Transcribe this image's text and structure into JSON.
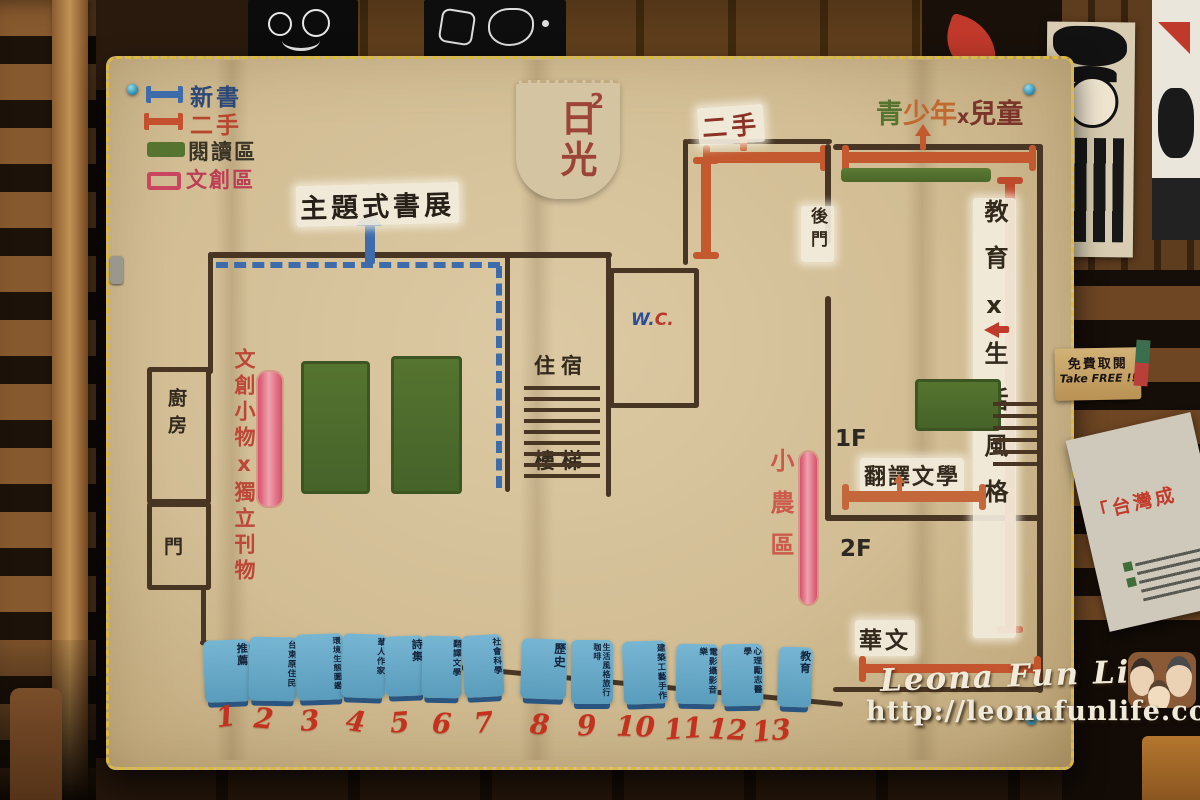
{
  "legend": {
    "items": [
      {
        "label": "新書",
        "color": "#3e6cab",
        "swatch": "ibeam"
      },
      {
        "label": "二手",
        "color": "#c4592f",
        "swatch": "ibeam"
      },
      {
        "label": "閱讀區",
        "color": "#55742f",
        "swatch": "filled"
      },
      {
        "label": "文創區",
        "color": "#c94560",
        "swatch": "outline"
      }
    ]
  },
  "store_tag": {
    "name": "日光",
    "sup": "2"
  },
  "map": {
    "title": "主題式書展",
    "labels": {
      "secondhand_top": "二手",
      "teen_green": "青",
      "teen_orange": "少年",
      "teen_x": "x",
      "teen_red": "兒童",
      "education": "教育x生活風格",
      "back_door": "後門",
      "stairs_line1": "住宿",
      "stairs_line2": "樓梯",
      "wc_w": "W.",
      "wc_c": "C.",
      "kitchen": "廚房",
      "door": "門",
      "cultural": "文創小物x獨立刊物",
      "farmer": "小農區",
      "floor1": "1F",
      "floor2": "2F",
      "translated": "翻譯文學",
      "chinese": "華文"
    }
  },
  "shelf_tags": [
    {
      "num": "1",
      "label": "推薦"
    },
    {
      "num": "2",
      "label": "台東原住民"
    },
    {
      "num": "3",
      "label": "環境生態圖鑑"
    },
    {
      "num": "4",
      "label": "華人作家"
    },
    {
      "num": "5",
      "label": "詩集"
    },
    {
      "num": "6",
      "label": "翻譯文學"
    },
    {
      "num": "7",
      "label": "社會科學"
    },
    {
      "num": "8",
      "label": "歷史"
    },
    {
      "num": "9",
      "label": "生活風格旅行咖啡"
    },
    {
      "num": "10",
      "label": "建築工藝手作"
    },
    {
      "num": "11",
      "label": "電影攝影音樂"
    },
    {
      "num": "12",
      "label": "心理勵志醫學"
    },
    {
      "num": "13",
      "label": "教育"
    }
  ],
  "wall_signs": {
    "take_free_cn": "免費取閱",
    "take_free_en": "Take FREE !!",
    "flyer_text": "「台灣成"
  },
  "watermark": {
    "title": "Leona Fun Life",
    "url": "http://leonafunlife.com/blog"
  },
  "colors": {
    "new_books_blue": "#3e6cab",
    "secondhand_orange": "#c4592f",
    "reading_green": "#55742f",
    "cultural_pink": "#d8506a"
  }
}
